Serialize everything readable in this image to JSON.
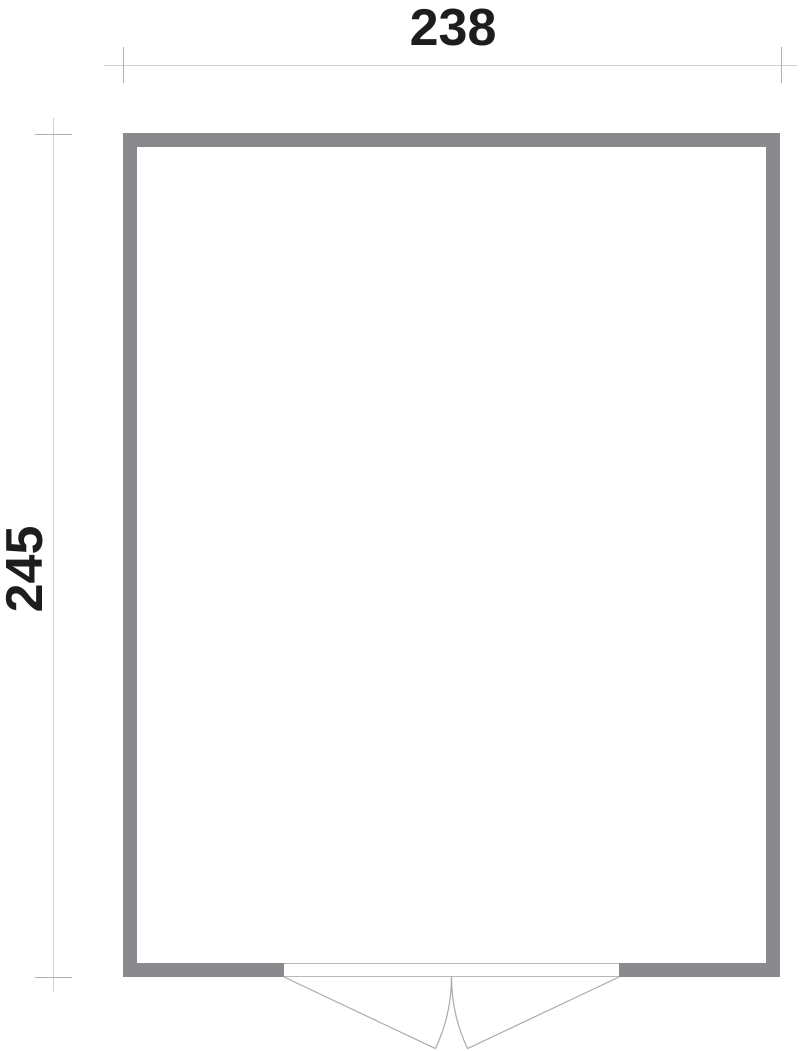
{
  "page": {
    "background": "#ffffff",
    "width": 800,
    "height": 1051,
    "description": "Floor plan top view of a rectangular building with double outward-swinging doors centered on the bottom wall"
  },
  "floor_plan": {
    "colors": {
      "wall_fill": "#8a8a8e",
      "interior_fill": "#ffffff",
      "dimension_line": "#cfcfcf",
      "dimension_tick": "#b0b0b2",
      "door_line": "#ababad",
      "threshold_line": "#b7b7b9",
      "label_text": "#1d1d1b"
    },
    "outer_rect": {
      "x": 123,
      "y": 133,
      "w": 657,
      "h": 844
    },
    "wall_thickness": 14,
    "door": {
      "opening_x1": 284,
      "opening_x2": 619,
      "hinge_y": 977,
      "leaf_length": 167.5,
      "open_angle_deg": 25.3,
      "leaf_count": 2
    },
    "dimensions": {
      "width": {
        "label": "238",
        "line_y": 65.5,
        "x1": 104,
        "x2": 797,
        "tick_x1": 123.5,
        "tick_x2": 781.5,
        "tick_y1": 47,
        "tick_y2": 83
      },
      "height": {
        "label": "245",
        "line_x": 53.5,
        "y1": 118,
        "y2": 992,
        "tick_y1": 134.5,
        "tick_y2": 977.5,
        "tick_x1": 35,
        "tick_x2": 72
      }
    }
  }
}
